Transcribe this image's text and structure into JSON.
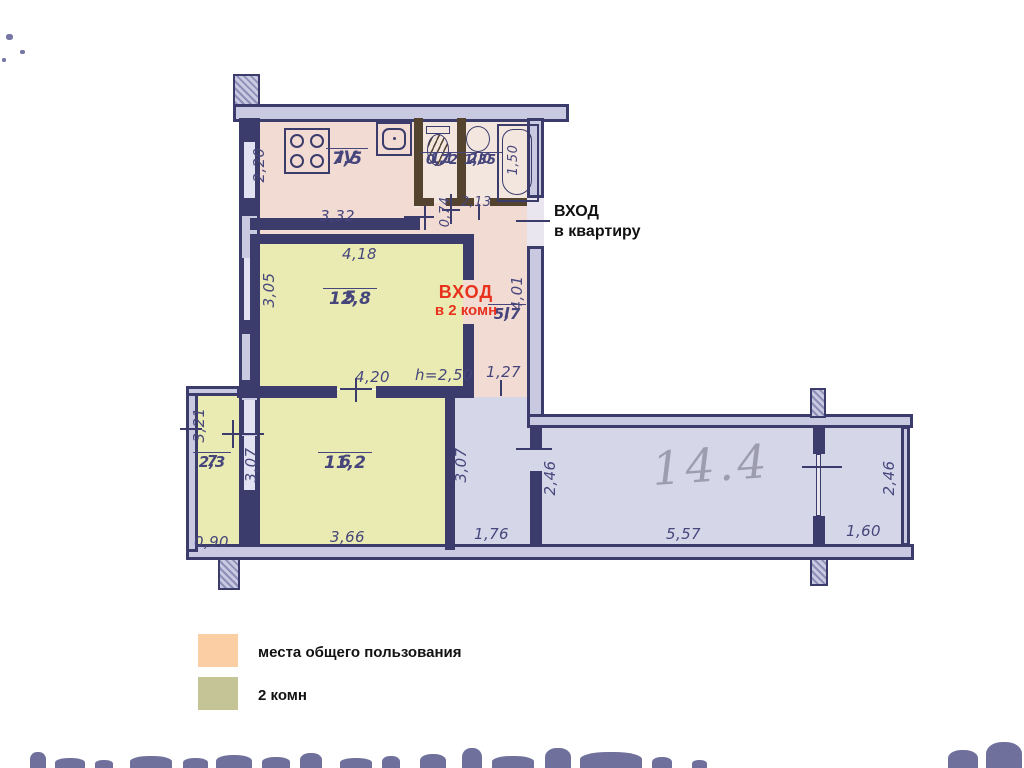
{
  "plan": {
    "entrance_apartment": {
      "line1": "ВХОД",
      "line2": "в квартиру"
    },
    "entrance_rooms": {
      "line1": "ВХОД",
      "line2": "в 2 комн"
    },
    "handwritten_area": "14.4",
    "rooms": {
      "kitchen": {
        "num": "IV",
        "area": "7,5"
      },
      "toilet": {
        "num": "1,1",
        "area": "0,72"
      },
      "bath": {
        "num": "2,0",
        "area": "1,35"
      },
      "room5": {
        "num": "5",
        "area": "12,8"
      },
      "hall": {
        "num": "I",
        "area": "5,7"
      },
      "room6": {
        "num": "6",
        "area": "11,2"
      },
      "room7": {
        "num": "7",
        "area": "2,3"
      }
    },
    "dims": {
      "kitchen_h": "2,20",
      "kitchen_w": "3,32",
      "toilet_door": "0,74",
      "bath_w": "2,13",
      "tub_len": "1,50",
      "room5_w_top": "4,18",
      "room5_h": "3,05",
      "room5_w_bottom": "4,20",
      "ceiling_h": "h=2,50",
      "hall_w": "1,27",
      "hall_h": "4,01",
      "room7_h": "3,21",
      "room7_w": "0,90",
      "room6_h": "3,07",
      "room6_w": "3,66",
      "corridor_h": "3,07",
      "corridor_w": "1,76",
      "bigroom_h": "2,46",
      "bigroom_w": "5,57",
      "right_w": "1,60",
      "right_h": "2,46"
    }
  },
  "legend": {
    "items": [
      {
        "label": "места общего пользования",
        "color": "#fbcfa3"
      },
      {
        "label": "2 комн",
        "color": "#c5c497"
      }
    ]
  },
  "colors": {
    "common_fill": "#f1dbd3",
    "rooms_fill": "#eaebb2",
    "other_fill": "#d6d6e9",
    "wall": "#3b3b6c",
    "wet_wall": "#54432f",
    "dim_text": "#46467c",
    "entrance_red": "#e8321e",
    "pencil": "#9d9dae"
  }
}
